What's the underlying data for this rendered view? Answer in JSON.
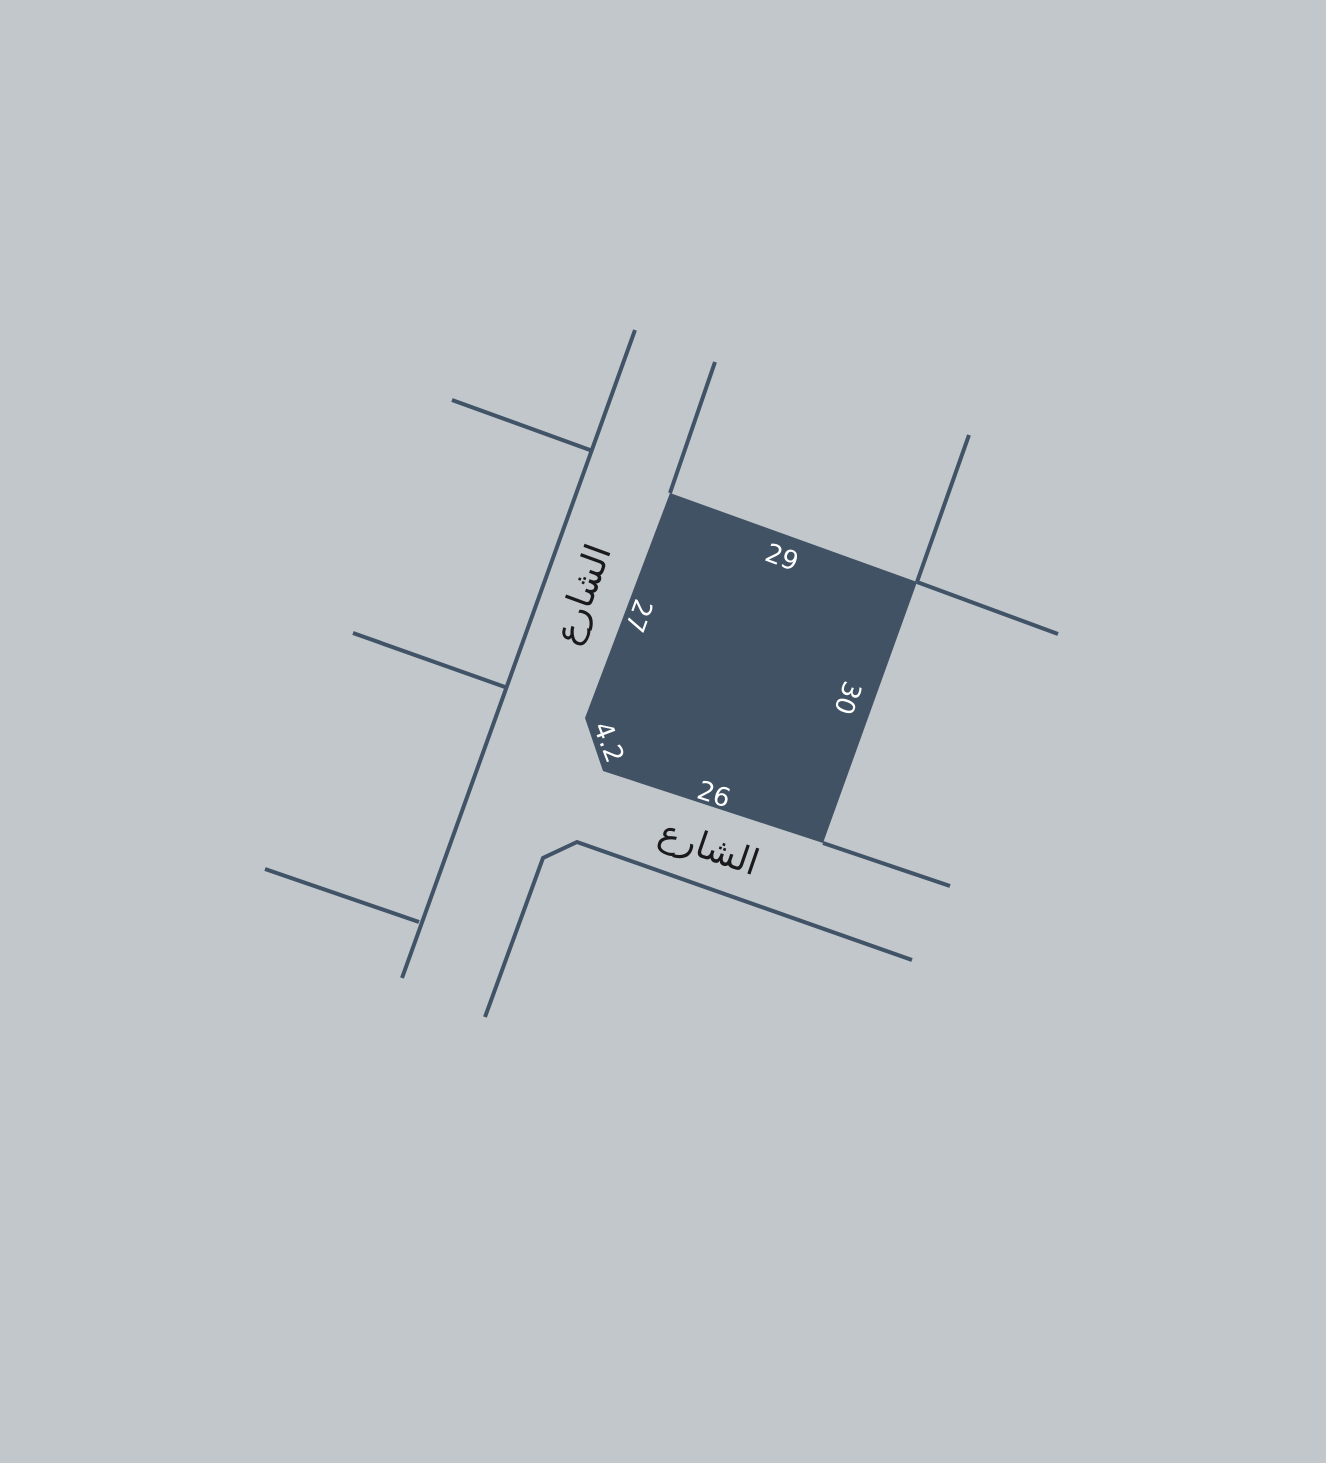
{
  "canvas": {
    "width": 1326,
    "height": 1463
  },
  "colors": {
    "background": "#c2c7cb",
    "parcel_fill": "#405264",
    "street_line": "#415366",
    "dimension_text": "#ffffff",
    "street_text": "#1a1a1c"
  },
  "map": {
    "parcel": {
      "points": "670,493 917,582 823,843 603,771 585,718",
      "edge_lengths": {
        "north_edge": "29",
        "west_edge": "27",
        "east_edge": "30",
        "south_edge": "26",
        "corner_chamfer": "4.2"
      }
    },
    "streets": [
      {
        "name": "main-street-west-boundary-line",
        "points": "635,330 402,978"
      },
      {
        "name": "main-street-east-boundary-line",
        "points": "715,362 670,493"
      },
      {
        "name": "side-street-stub-north",
        "points": "452,400 590,450"
      },
      {
        "name": "side-street-stub-middle",
        "points": "353,633 505,687"
      },
      {
        "name": "side-street-stub-south",
        "points": "265,869 419,922"
      },
      {
        "name": "parcel-east-edge-extension-line",
        "points": "969,435 917,582"
      },
      {
        "name": "cross-street-northeast-line",
        "points": "917,582 1058,634"
      },
      {
        "name": "south-street-north-boundary-line",
        "points": "823,843 950,886"
      },
      {
        "name": "south-street-south-boundary-line",
        "points": "485,1017 543,858 577,842 912,960"
      }
    ],
    "labels": [
      {
        "name": "dimension-north-edge",
        "text": "29",
        "x": 782,
        "y": 557,
        "rotate": 20,
        "type": "dimension"
      },
      {
        "name": "dimension-west-edge",
        "text": "27",
        "x": 639,
        "y": 616,
        "rotate": 110,
        "type": "dimension"
      },
      {
        "name": "dimension-east-edge",
        "text": "30",
        "x": 848,
        "y": 698,
        "rotate": 110,
        "type": "dimension"
      },
      {
        "name": "dimension-south-edge",
        "text": "26",
        "x": 714,
        "y": 794,
        "rotate": 18,
        "type": "dimension"
      },
      {
        "name": "dimension-corner-chamfer",
        "text": "4.2",
        "x": 609,
        "y": 742,
        "rotate": 69,
        "type": "dimension"
      },
      {
        "name": "street-name-label-west",
        "text": "الشارع",
        "x": 582,
        "y": 594,
        "rotate": -70,
        "type": "street-name"
      },
      {
        "name": "street-name-label-south",
        "text": "الشارع",
        "x": 709,
        "y": 847,
        "rotate": 19,
        "type": "street-name"
      }
    ]
  }
}
